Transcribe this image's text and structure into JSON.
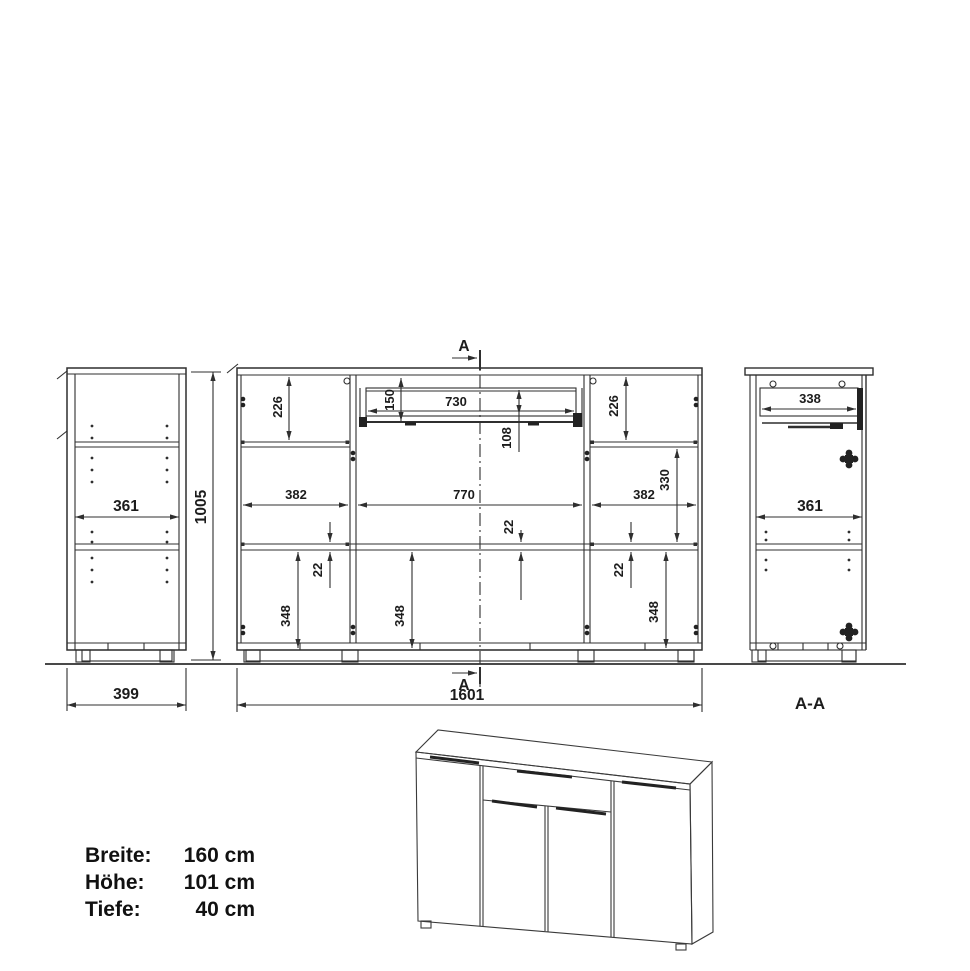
{
  "side_view": {
    "inner_width": "361",
    "height": "1005",
    "depth": "399"
  },
  "front_view": {
    "left_top_height": "226",
    "right_top_height": "226",
    "drawer_front_height": "150",
    "drawer_width": "730",
    "drawer_box_height": "108",
    "left_width": "382",
    "middle_width": "770",
    "right_width": "382",
    "right_upper_height": "330",
    "left_shelf_thickness": "22",
    "middle_shelf_thickness": "22",
    "right_shelf_thickness": "22",
    "left_lower_height": "348",
    "middle_lower_height": "348",
    "right_lower_height": "348",
    "total_width": "1601",
    "section_marker_top": "A",
    "section_marker_bottom": "A"
  },
  "section_view": {
    "drawer_depth": "338",
    "inner_width": "361",
    "title": "A-A"
  },
  "specs": {
    "rows": [
      {
        "label": "Breite:",
        "value": "160 cm"
      },
      {
        "label": "Höhe:",
        "value": "101 cm"
      },
      {
        "label": "Tiefe:",
        "value": "40 cm"
      }
    ]
  }
}
